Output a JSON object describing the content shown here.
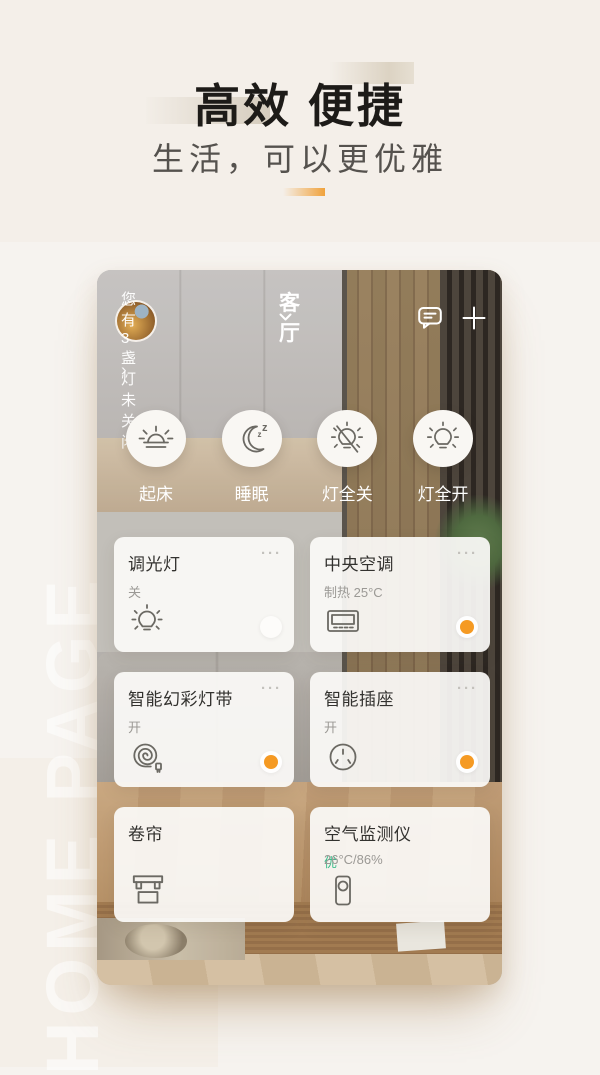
{
  "hero": {
    "title": "高效 便捷",
    "subtitle": "生活，可以更优雅",
    "watermark": "HOME PAGE",
    "accent_color": "#F0A23C"
  },
  "phone": {
    "header": {
      "room": "客厅",
      "notification": "您有3盏灯未关闭",
      "notification_arrow": "›"
    },
    "ui": {
      "menu_dots": "···"
    },
    "scenes": [
      {
        "label": "起床",
        "icon": "sunrise-icon"
      },
      {
        "label": "睡眠",
        "icon": "moon-icon"
      },
      {
        "label": "灯全关",
        "icon": "lights-off-icon"
      },
      {
        "label": "灯全开",
        "icon": "lights-on-icon"
      }
    ],
    "devices": [
      {
        "name": "调光灯",
        "status": "关",
        "icon": "bulb-icon",
        "toggle": "off"
      },
      {
        "name": "中央空调",
        "status": "制热 25°C",
        "icon": "ac-icon",
        "toggle": "on"
      },
      {
        "name": "智能幻彩灯带",
        "status": "开",
        "icon": "light-strip-icon",
        "toggle": "on"
      },
      {
        "name": "智能插座",
        "status": "开",
        "icon": "socket-icon",
        "toggle": "on"
      },
      {
        "name": "卷帘",
        "status": "",
        "icon": "blind-icon",
        "toggle": "none"
      },
      {
        "name": "空气监测仪",
        "status_level": "优",
        "status": "26°C/86%",
        "icon": "air-monitor-icon",
        "toggle": "none"
      }
    ],
    "colors": {
      "accent_orange": "#F59A23",
      "good_green": "#3EBD8C"
    }
  }
}
